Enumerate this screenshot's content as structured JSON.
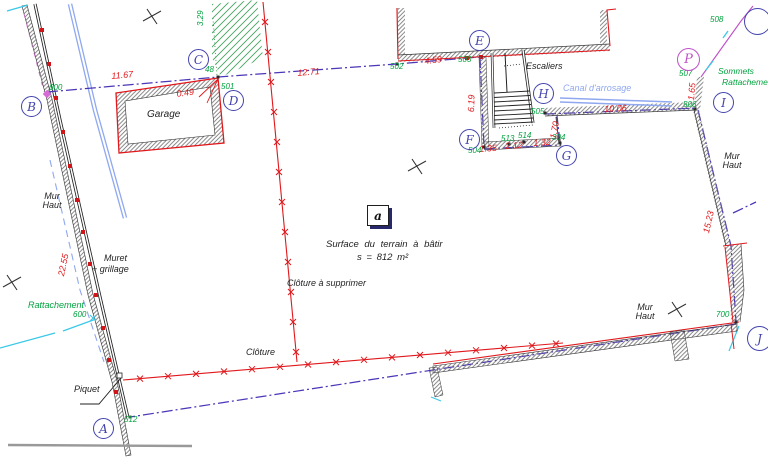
{
  "title": "Plan de division - terrain à bâtir",
  "colors": {
    "boundary_purple": "#4b36b8",
    "measure_red": "#e0181c",
    "point_green": "#00a33e",
    "canal_blue": "#8fa8ef",
    "circle_blue": "#4343ad",
    "station_magenta": "#c050c8",
    "tie_cyan": "#3cc8e8"
  },
  "parcel": {
    "label": "a",
    "surface_line1": "Surface du terrain à bâtir",
    "surface_line2": "s = 812 m²"
  },
  "measurements": {
    "bc": "11.67",
    "corner": "0.49",
    "ce": "12.71",
    "e1": "4.59",
    "ef": "6.19",
    "f1": "1.35",
    "f2": "2.12",
    "f3": "1.32",
    "gh": "1.70",
    "hi": "10.06",
    "pi": "1.65",
    "east_wall": "15.23",
    "west_wall": "22.55",
    "green_tie": "3.29"
  },
  "points": {
    "circled": {
      "a": "A",
      "b": "B",
      "c": "C",
      "d": "D",
      "e": "E",
      "f": "F",
      "g": "G",
      "h": "H",
      "i": "I",
      "p": "P",
      "j": "J"
    },
    "numbers": {
      "n48": "48",
      "n501": "501",
      "n502": "502",
      "n503": "503",
      "n504": "504",
      "n505": "505",
      "n506": "506",
      "n507": "507",
      "n508": "508",
      "n512": "512",
      "n513": "513",
      "n514": "514",
      "n304": "304",
      "n600": "600",
      "n700": "700",
      "tie600": "600"
    }
  },
  "labels": {
    "garage": "Garage",
    "escaliers": "Escaliers",
    "canal": "Canal d'arrosage",
    "mur_line1": "Mur",
    "mur_line2": "Haut",
    "muret_line1": "Muret",
    "muret_line2": "+ grillage",
    "cloture": "Clôture",
    "cloture_supprimer": "Clôture à supprimer",
    "piquet": "Piquet",
    "rattachement": "Rattachement",
    "sommets_line1": "Sommets",
    "sommets_line2": "Rattachement"
  }
}
